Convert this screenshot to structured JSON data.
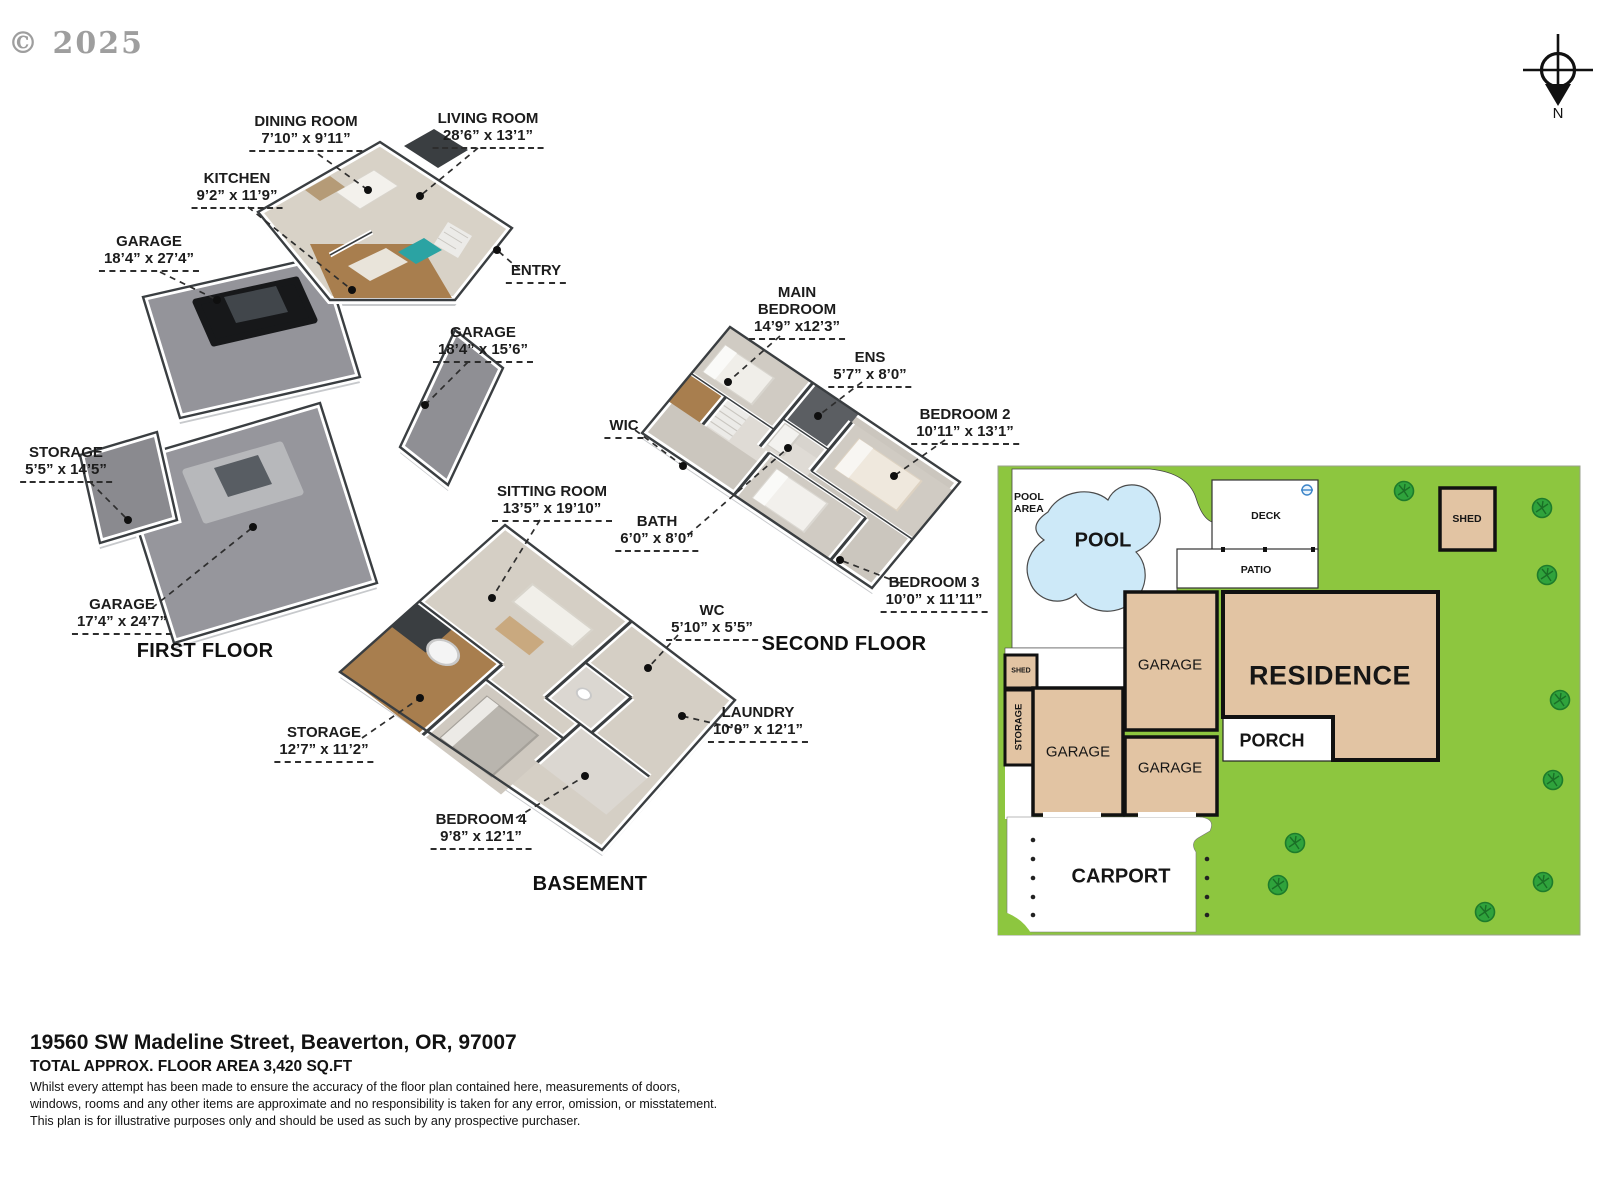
{
  "copyright": "© 2025",
  "compass": {
    "north": "N"
  },
  "first_floor": {
    "caption": "FIRST FLOOR",
    "rooms": {
      "dining": {
        "name": "DINING ROOM",
        "dims": "7’10” x 9’11”"
      },
      "living": {
        "name": "LIVING ROOM",
        "dims": "28’6” x 13’1”"
      },
      "kitchen": {
        "name": "KITCHEN",
        "dims": "9’2” x 11’9”"
      },
      "garage_large": {
        "name": "GARAGE",
        "dims": "18’4” x 27’4”"
      },
      "entry": {
        "name": "ENTRY"
      },
      "garage_right": {
        "name": "GARAGE",
        "dims": "18’4” x 15’6”"
      },
      "storage": {
        "name": "STORAGE",
        "dims": "5’5” x 14’5”"
      },
      "garage_lower": {
        "name": "GARAGE",
        "dims": "17’4” x 24’7”"
      }
    }
  },
  "second_floor": {
    "caption": "SECOND FLOOR",
    "rooms": {
      "main_bedroom": {
        "name_line1": "MAIN",
        "name_line2": "BEDROOM",
        "dims": "14’9” x12’3”"
      },
      "ens": {
        "name": "ENS",
        "dims": "5’7” x 8’0”"
      },
      "bedroom2": {
        "name": "BEDROOM 2",
        "dims": "10’11” x 13’1”"
      },
      "wic": {
        "name": "WIC"
      },
      "bath": {
        "name": "BATH",
        "dims": "6’0” x 8’0”"
      },
      "bedroom3": {
        "name": "BEDROOM 3",
        "dims": "10’0” x 11’11”"
      }
    }
  },
  "basement": {
    "caption": "BASEMENT",
    "rooms": {
      "sitting": {
        "name": "SITTING ROOM",
        "dims": "13’5” x 19’10”"
      },
      "wc": {
        "name": "WC",
        "dims": "5’10” x 5’5”"
      },
      "storage": {
        "name": "STORAGE",
        "dims": "12’7” x 11’2”"
      },
      "laundry": {
        "name": "LAUNDRY",
        "dims": "10’0” x 12’1”"
      },
      "bedroom4": {
        "name": "BEDROOM 4",
        "dims": "9’8” x 12’1”"
      }
    }
  },
  "site_plan": {
    "pool_area_line1": "POOL",
    "pool_area_line2": "AREA",
    "pool": "POOL",
    "deck": "DECK",
    "patio": "PATIO",
    "shed_small": "SHED",
    "storage": "STORAGE",
    "garage_left": "GARAGE",
    "garage_top": "GARAGE",
    "garage_bottom": "GARAGE",
    "residence": "RESIDENCE",
    "porch": "PORCH",
    "carport": "CARPORT",
    "shed_right": "SHED"
  },
  "footer": {
    "address": "19560 SW Madeline Street, Beaverton, OR, 97007",
    "area": "TOTAL APPROX. FLOOR AREA 3,420 SQ.FT",
    "disclaimer_line1": "Whilst every attempt has been made to ensure the accuracy of the floor plan contained here, measurements of doors,",
    "disclaimer_line2": "windows, rooms and any other items are approximate and no responsibility is taken for any error, omission, or misstatement.",
    "disclaimer_line3": "This plan is for illustrative purposes only and should be used as such by any prospective purchaser."
  },
  "colors": {
    "lawn_green": "#8dc63f",
    "tree_green": "#2fa33c",
    "building_tan": "#e2c4a3",
    "pool_blue": "#cde9f8",
    "wall_top_gray": "#3a3e41",
    "garage_floor_gray": "#94949a",
    "living_floor_beige": "#d8d2c7",
    "wood_floor_brown": "#a87e4e"
  }
}
